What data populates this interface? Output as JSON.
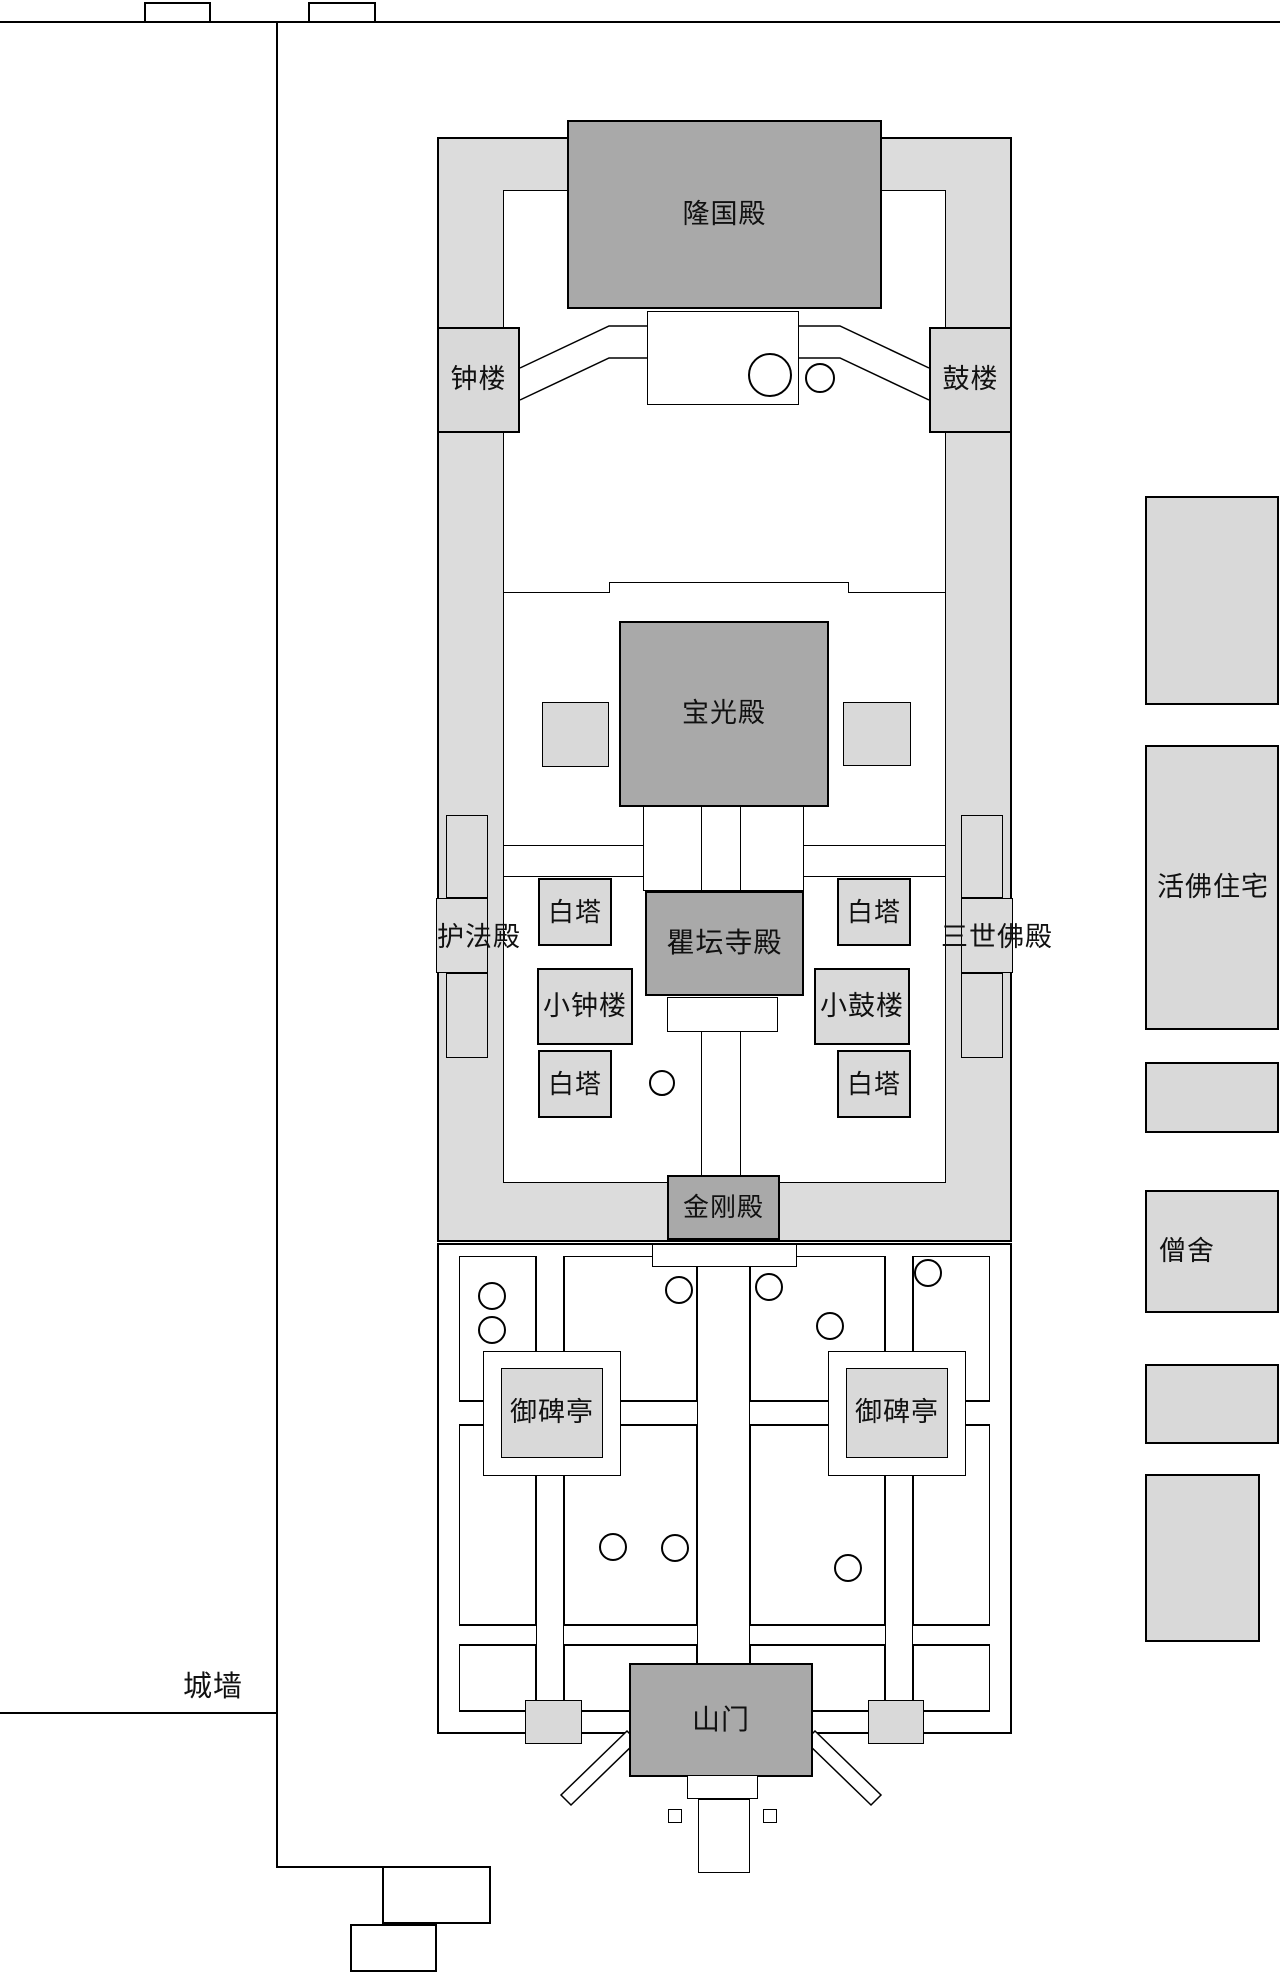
{
  "palette": {
    "building_dark": "#a9a9a9",
    "box_light": "#d9d9d9",
    "corridor": "#dcdcdc",
    "line": "#000000",
    "bg": "#ffffff"
  },
  "labels": {
    "longguo_hall": "隆国殿",
    "bell_tower": "钟楼",
    "drum_tower": "鼓楼",
    "baoguang_hall": "宝光殿",
    "hufa_hall": "护法殿",
    "white_pagoda": "白塔",
    "qutan_temple_hall": "瞿坛寺殿",
    "three_buddha_hall": "三世佛殿",
    "small_bell_tower": "小钟楼",
    "small_drum_tower": "小鼓楼",
    "vajra_hall": "金刚殿",
    "imperial_stele_pavilion": "御碑亭",
    "mountain_gate": "山门",
    "city_wall": "城墙",
    "living_buddha_residence": "活佛住宅",
    "monk_quarters": "僧舍"
  }
}
